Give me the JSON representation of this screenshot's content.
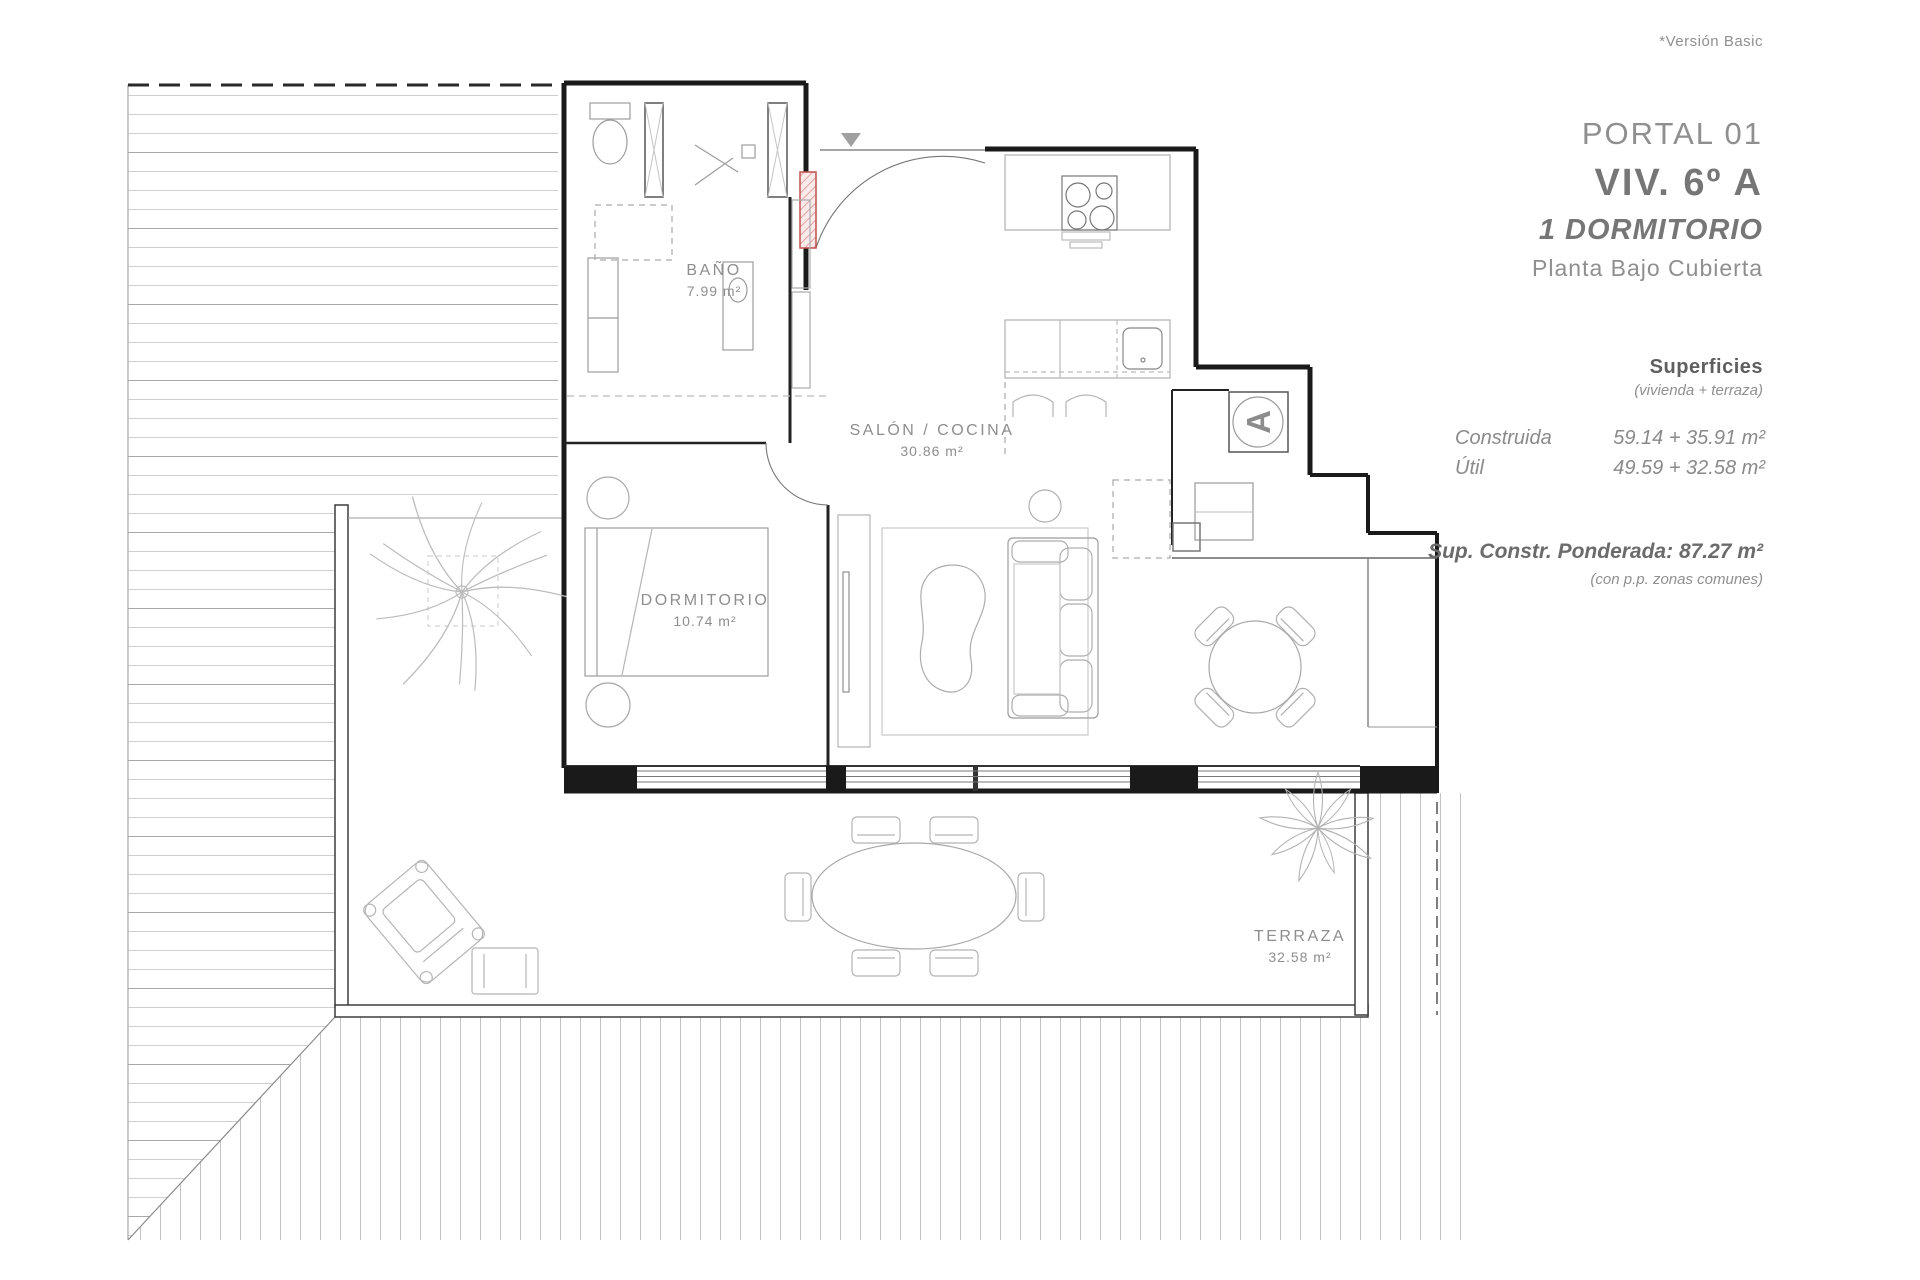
{
  "meta": {
    "version_note": "*Versión Basic"
  },
  "info_panel": {
    "portal": "PORTAL 01",
    "unit": "VIV. 6º A",
    "type": "1 DORMITORIO",
    "floor": "Planta Bajo Cubierta",
    "surfaces_title": "Superficies",
    "surfaces_subtitle": "(vivienda + terraza)",
    "rows": [
      {
        "label": "Construida",
        "value": "59.14 + 35.91 m²"
      },
      {
        "label": "Útil",
        "value": "49.59 + 32.58 m²"
      }
    ],
    "ponderada": "Sup. Constr. Ponderada: 87.27 m²",
    "ponderada_note": "(con p.p. zonas comunes)"
  },
  "rooms": [
    {
      "name": "BAÑO",
      "area": "7.99 m²"
    },
    {
      "name": "SALÓN / COCINA",
      "area": "30.86 m²"
    },
    {
      "name": "DORMITORIO",
      "area": "10.74 m²"
    },
    {
      "name": "TERRAZA",
      "area": "32.58 m²"
    }
  ],
  "markers": {
    "unit_letter": "A"
  },
  "colors": {
    "wall": "#1a1a1a",
    "hatch": "#c6c6c6",
    "furniture": "#b0b0b0",
    "text_gray": "#8e8e8e",
    "door_red": "#c0504d"
  }
}
